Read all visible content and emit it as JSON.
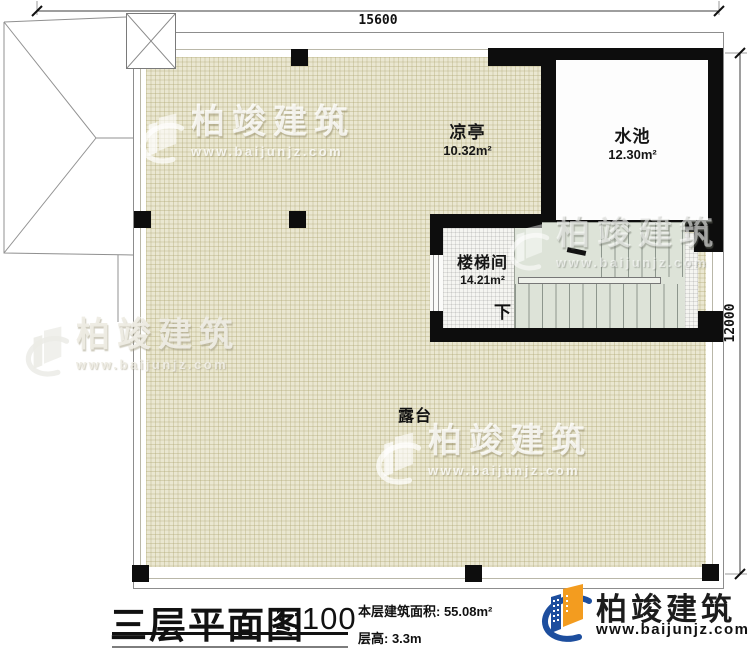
{
  "plan": {
    "dimensions": {
      "top": "15600",
      "right": "12000"
    },
    "rooms": {
      "pavilion": {
        "name": "凉亭",
        "area": "10.32m²"
      },
      "pool": {
        "name": "水池",
        "area": "12.30m²"
      },
      "stairwell": {
        "name": "楼梯间",
        "area": "14.21m²"
      },
      "terrace": {
        "name": "露台"
      }
    },
    "stair_direction_label": "下"
  },
  "title_block": {
    "title": "三层平面图",
    "scale": "1:100",
    "area_text": "本层建筑面积: 55.08m²",
    "floor_height_text": "层高: 3.3m"
  },
  "brand": {
    "name": "柏竣建筑",
    "website": "www.baijunjz.com",
    "colors": {
      "blue": "#1d4e9e",
      "orange": "#f39c1f"
    }
  },
  "watermark": {
    "name": "柏竣建筑",
    "website": "www.baijunjz.com"
  }
}
